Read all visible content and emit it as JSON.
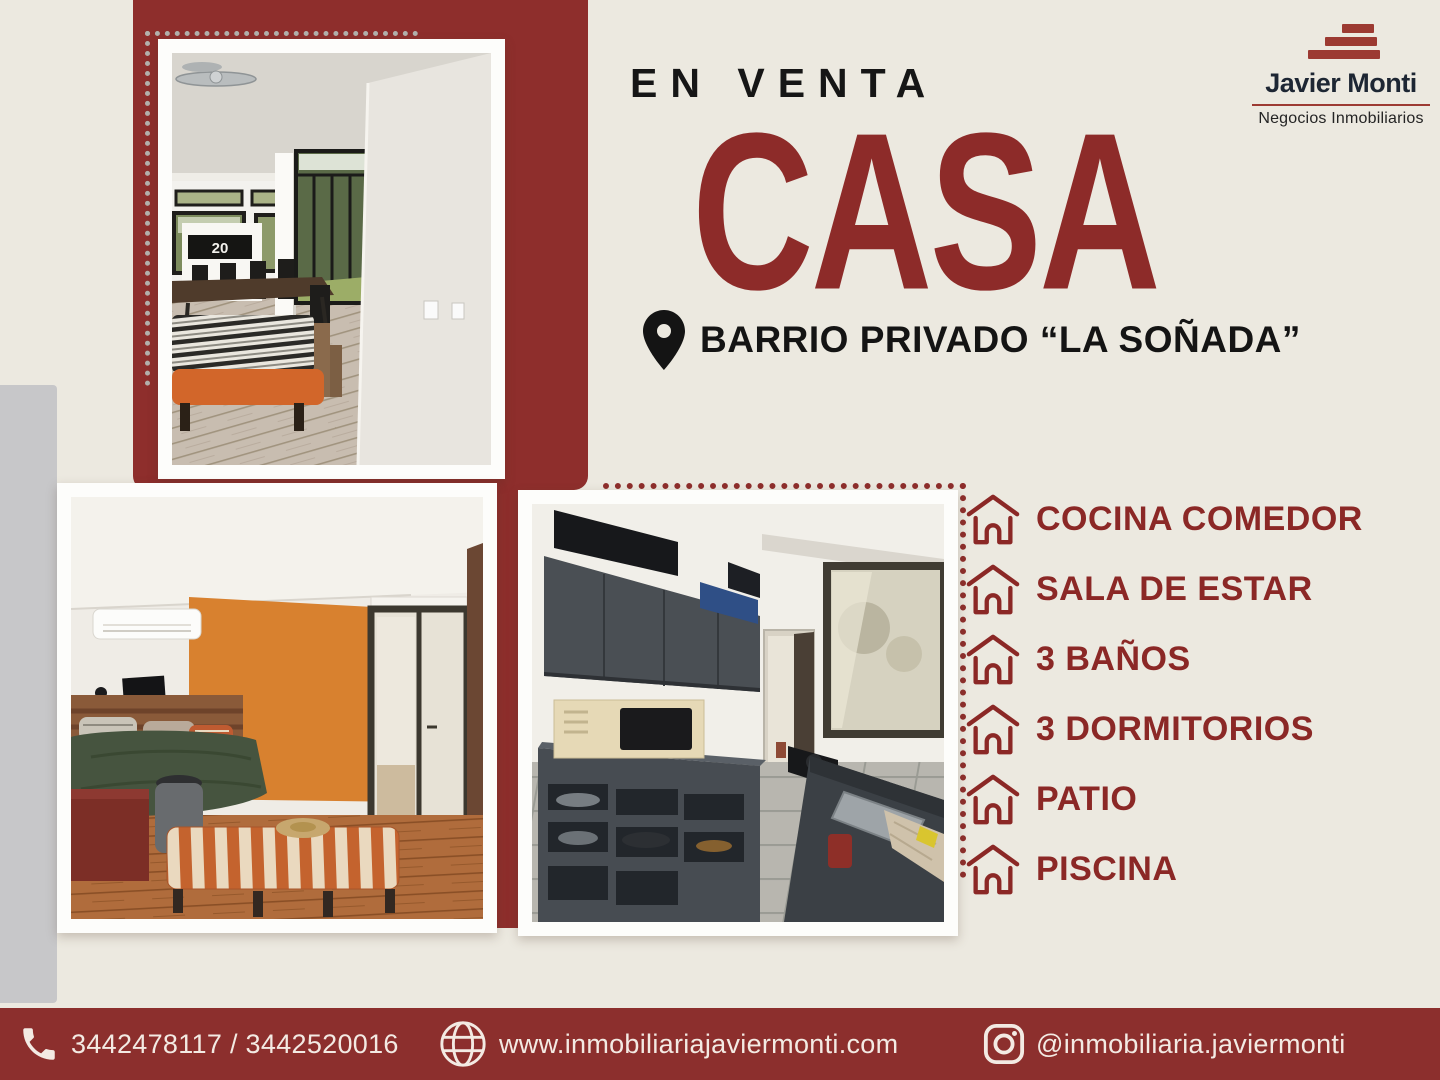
{
  "header": {
    "kicker": "EN VENTA",
    "title": "CASA",
    "location": "BARRIO PRIVADO “LA SOÑADA”",
    "location_icon": "location-pin-icon"
  },
  "logo": {
    "name": "Javier Monti",
    "tagline": "Negocios Inmobiliarios",
    "mark": "stacked-bars-icon"
  },
  "photos": [
    {
      "name": "living-dining-room",
      "overlay_text": "20"
    },
    {
      "name": "bedroom"
    },
    {
      "name": "kitchen"
    }
  ],
  "features": [
    {
      "icon": "house-icon",
      "label": "COCINA COMEDOR"
    },
    {
      "icon": "house-icon",
      "label": "SALA DE ESTAR"
    },
    {
      "icon": "house-icon",
      "label": "3 BAÑOS"
    },
    {
      "icon": "house-icon",
      "label": "3 DORMITORIOS"
    },
    {
      "icon": "house-icon",
      "label": "PATIO"
    },
    {
      "icon": "house-icon",
      "label": "PISCINA"
    }
  ],
  "footer": {
    "phone": "3442478117 / 3442520016",
    "phone_icon": "phone-icon",
    "website": "www.inmobiliariajaviermonti.com",
    "website_icon": "globe-icon",
    "instagram": "@inmobiliaria.javiermonti",
    "instagram_icon": "instagram-icon"
  },
  "colors": {
    "accent_red": "#8E2E2C",
    "background_cream": "#ECE9E0",
    "footer_red": "#8C2F2D",
    "feature_text": "#8B2826",
    "logo_red": "#9C3A32",
    "gray_shape": "#C7C7C9",
    "heading_black": "#161616",
    "footer_text": "#F3EAE3"
  }
}
